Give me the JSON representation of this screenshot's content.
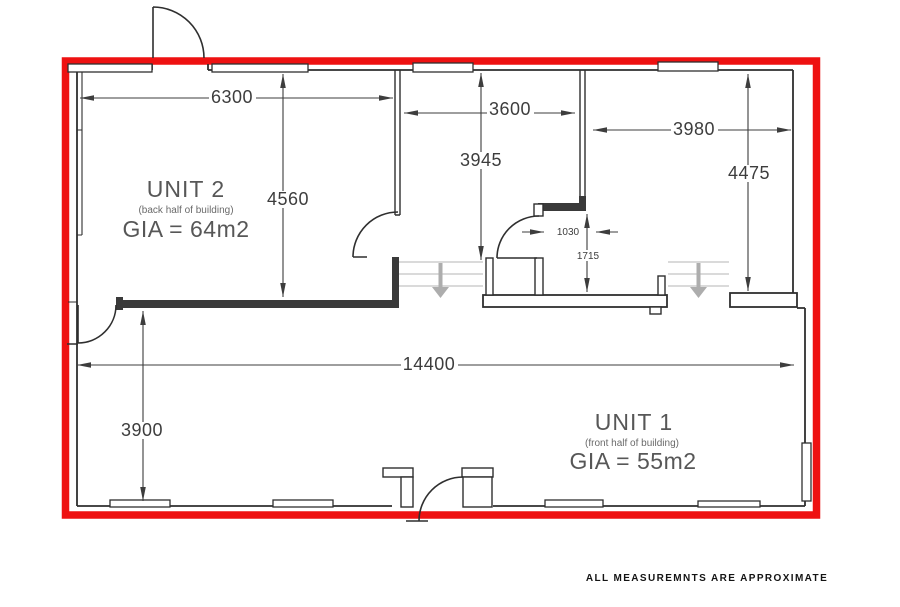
{
  "plan": {
    "units": {
      "unit2": {
        "name": "UNIT 2",
        "subtitle": "(back half of building)",
        "area": "GIA = 64m2"
      },
      "unit1": {
        "name": "UNIT 1",
        "subtitle": "(front half of building)",
        "area": "GIA = 55m2"
      }
    },
    "dimensions": {
      "unit2_width": "6300",
      "unit2_depth": "4560",
      "middle_room_width": "3600",
      "middle_room_depth": "3945",
      "right_room_width": "3980",
      "right_room_depth": "4475",
      "building_width": "14400",
      "unit1_depth": "3900",
      "lobby_opening": "1030",
      "lobby_depth": "1715"
    },
    "note": "ALL MEASUREMNTS ARE APPROXIMATE",
    "colors": {
      "boundary": "#ee1111",
      "walls": "#2f2f2f",
      "dimension_text": "#3d3d3d",
      "unit_text": "#575757",
      "steps": "#c4c4c4",
      "step_arrows": "#adadad"
    }
  }
}
